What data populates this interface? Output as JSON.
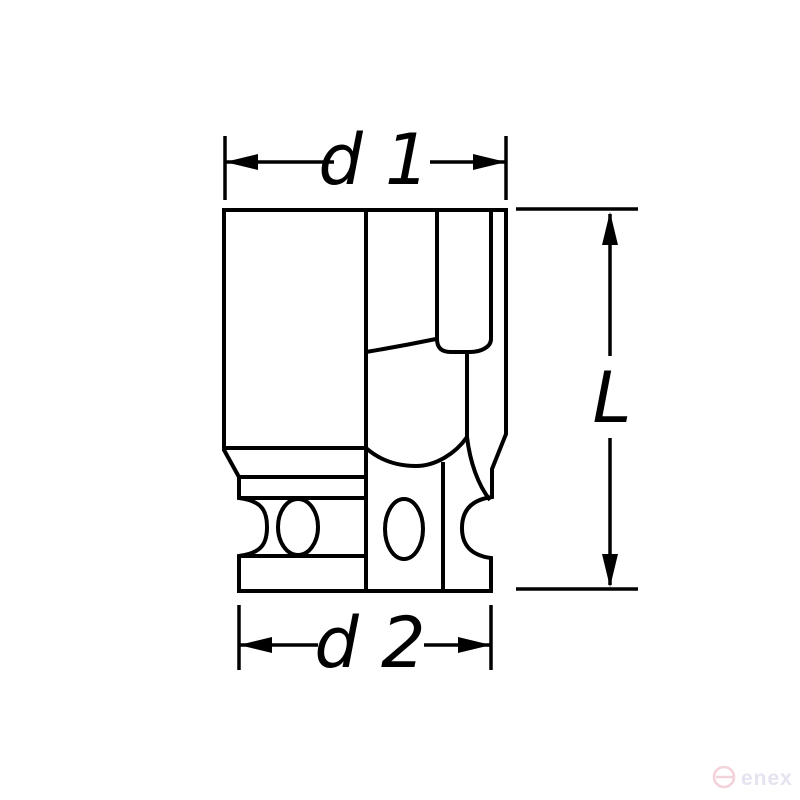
{
  "page": {
    "background": "#ffffff"
  },
  "drawing": {
    "type": "technical-line-drawing",
    "subject": "hex impact socket, front elevation with half section",
    "line_color": "#000000",
    "labels": {
      "d1": "d 1",
      "d2": "d 2",
      "length": "L"
    }
  },
  "watermark": {
    "logo_icon": "enex-circle-e-icon",
    "text": "enex",
    "circle_color": "#f4d2da",
    "text_color": "#e6e3f0"
  }
}
